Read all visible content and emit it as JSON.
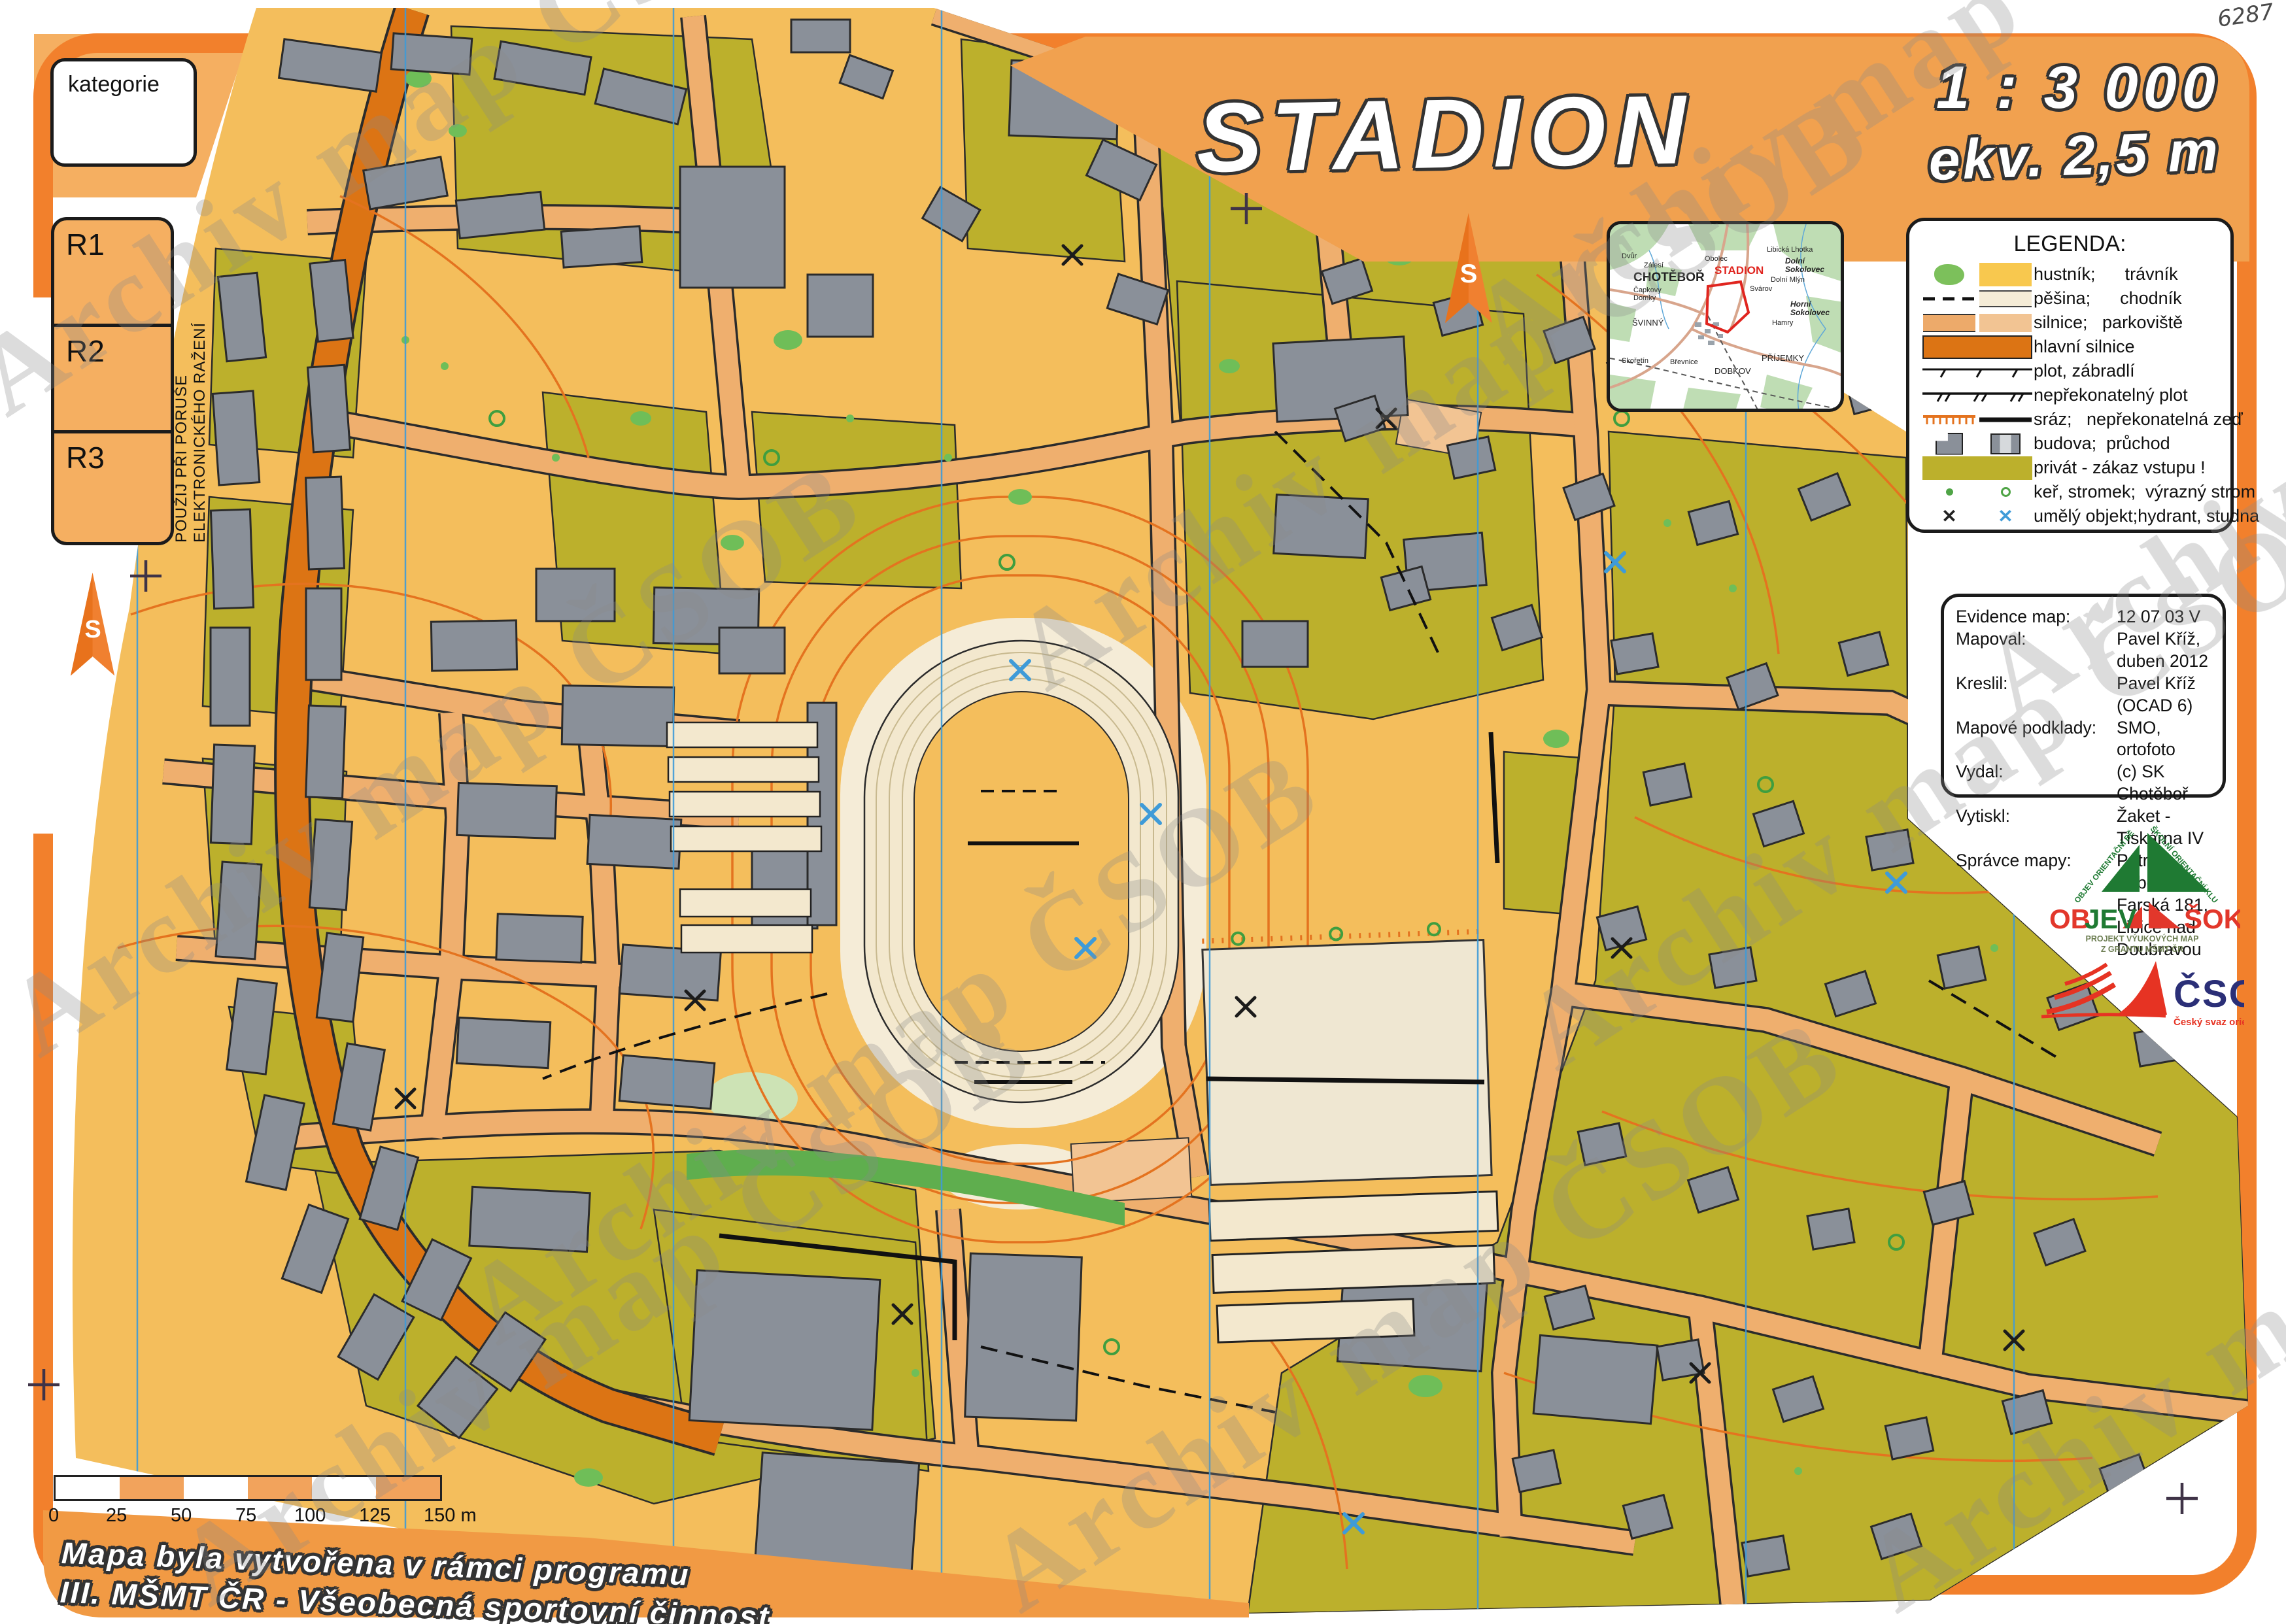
{
  "page": {
    "watermark": "Archiv map ČSOB",
    "handwritten_number": "6287"
  },
  "header": {
    "title": "STADION",
    "scale": "1 : 3 000",
    "equidistance": "ekv. 2,5 m"
  },
  "category_box": {
    "label": "kategorie"
  },
  "control_boxes": {
    "r1": "R1",
    "r2": "R2",
    "r3": "R3"
  },
  "side_note": "POUŽIJ PŘI PORUŠE ELEKTRONICKÉHO RAŽENÍ",
  "north_arrow": {
    "label": "S"
  },
  "inset_map": {
    "highlight_label": "STADION",
    "labels": [
      "Dvůr",
      "Zálesí",
      "Obolec",
      "Libická Lhotka",
      "Dolní\nSokolovec",
      "CHOTĚBOŘ",
      "Čapkovy\nDomky",
      "Dolní Mlýn",
      "Svárov",
      "Horní\nSokolovec",
      "ŠVINNÝ",
      "Hamry",
      "Skořetín",
      "Břevnice",
      "DOBKOV",
      "PŘÍJEMKY"
    ]
  },
  "legend": {
    "title": "LEGENDA:",
    "items": [
      {
        "symbols": [
          "thicket-blob",
          "lawn-swatch"
        ],
        "label": "hustník;      trávník"
      },
      {
        "symbols": [
          "footpath-dash",
          "pavement-swatch"
        ],
        "label": "pěšina;      chodník"
      },
      {
        "symbols": [
          "road-swatch",
          "parking-swatch"
        ],
        "label": "silnice;   parkoviště"
      },
      {
        "symbols": [
          "main-road-swatch"
        ],
        "label": "hlavní silnice"
      },
      {
        "symbols": [
          "fence-line"
        ],
        "label": "plot, zábradlí"
      },
      {
        "symbols": [
          "impassable-fence-line"
        ],
        "label": "nepřekonatelný plot"
      },
      {
        "symbols": [
          "earth-bank",
          "impassable-wall"
        ],
        "label": "sráz;   nepřekonatelná zeď"
      },
      {
        "symbols": [
          "building-glyph",
          "passage-glyph"
        ],
        "label": "budova;  průchod"
      },
      {
        "symbols": [
          "private-swatch"
        ],
        "label": "privát - zákaz vstupu !"
      },
      {
        "symbols": [
          "bush-dot",
          "tree-ring"
        ],
        "label": "keř, stromek;  výrazný strom"
      },
      {
        "symbols": [
          "black-cross",
          "blue-cross"
        ],
        "label": "umělý objekt;hydrant, studna"
      }
    ]
  },
  "evidence": {
    "rows": [
      {
        "label": "Evidence map:",
        "value": "12 07 03 V"
      },
      {
        "label": "Mapoval:",
        "value": "Pavel Kříž,  duben 2012"
      },
      {
        "label": "Kreslil:",
        "value": "Pavel Kříž  (OCAD 6)"
      },
      {
        "label": "Mapové podklady:",
        "value": "SMO, ortofoto"
      },
      {
        "label": "Vydal:",
        "value": "(c) SK Chotěboř"
      },
      {
        "label": "Vytiskl:",
        "value": "Žaket - Tiskárna IV"
      },
      {
        "label": "Správce mapy:",
        "value": "Petr Voborník,\nFarská 181,\nLibice nad Doubravou"
      }
    ]
  },
  "logos": {
    "objev_sok": {
      "arc_left": "OBJEV ORIENTAČNÍ BĚH",
      "arc_right": "ŠKOLNÍ ORIENTAČNÍ KLUBY",
      "word_left_red": "OB",
      "word_left_green": "JEV",
      "word_right": "ŠOK",
      "subtitle_line1": "PROJEKT VÝUKOVÝCH MAP",
      "subtitle_line2": "Z GRANTU MŠMT ČR"
    },
    "csos": {
      "name": "ČSOS",
      "subtitle": "Český svaz orientačních sportů"
    }
  },
  "scale_bar": {
    "ticks": [
      "0",
      "25",
      "50",
      "75",
      "100",
      "125",
      "150 m"
    ]
  },
  "footer": {
    "line1": "Mapa byla vytvořena v rámci programu",
    "line2": "III. MŠMT ČR - Všeobecná sportovní činnost"
  },
  "colors": {
    "frame_orange": "#F2802C",
    "banner_orange": "#F1A14F",
    "open_land": "#F4BE5C",
    "private_olive": "#BCB02C",
    "building_gray": "#8A9099",
    "main_road": "#DC7414",
    "road": "#EFAF6E",
    "footpath_cream": "#F5ECD7",
    "contour": "#E4731F",
    "meridian_blue": "#3F9BD8",
    "vegetation": "#6FBE58",
    "highlight_red": "#E0251F",
    "csos_navy": "#2B2F77"
  }
}
